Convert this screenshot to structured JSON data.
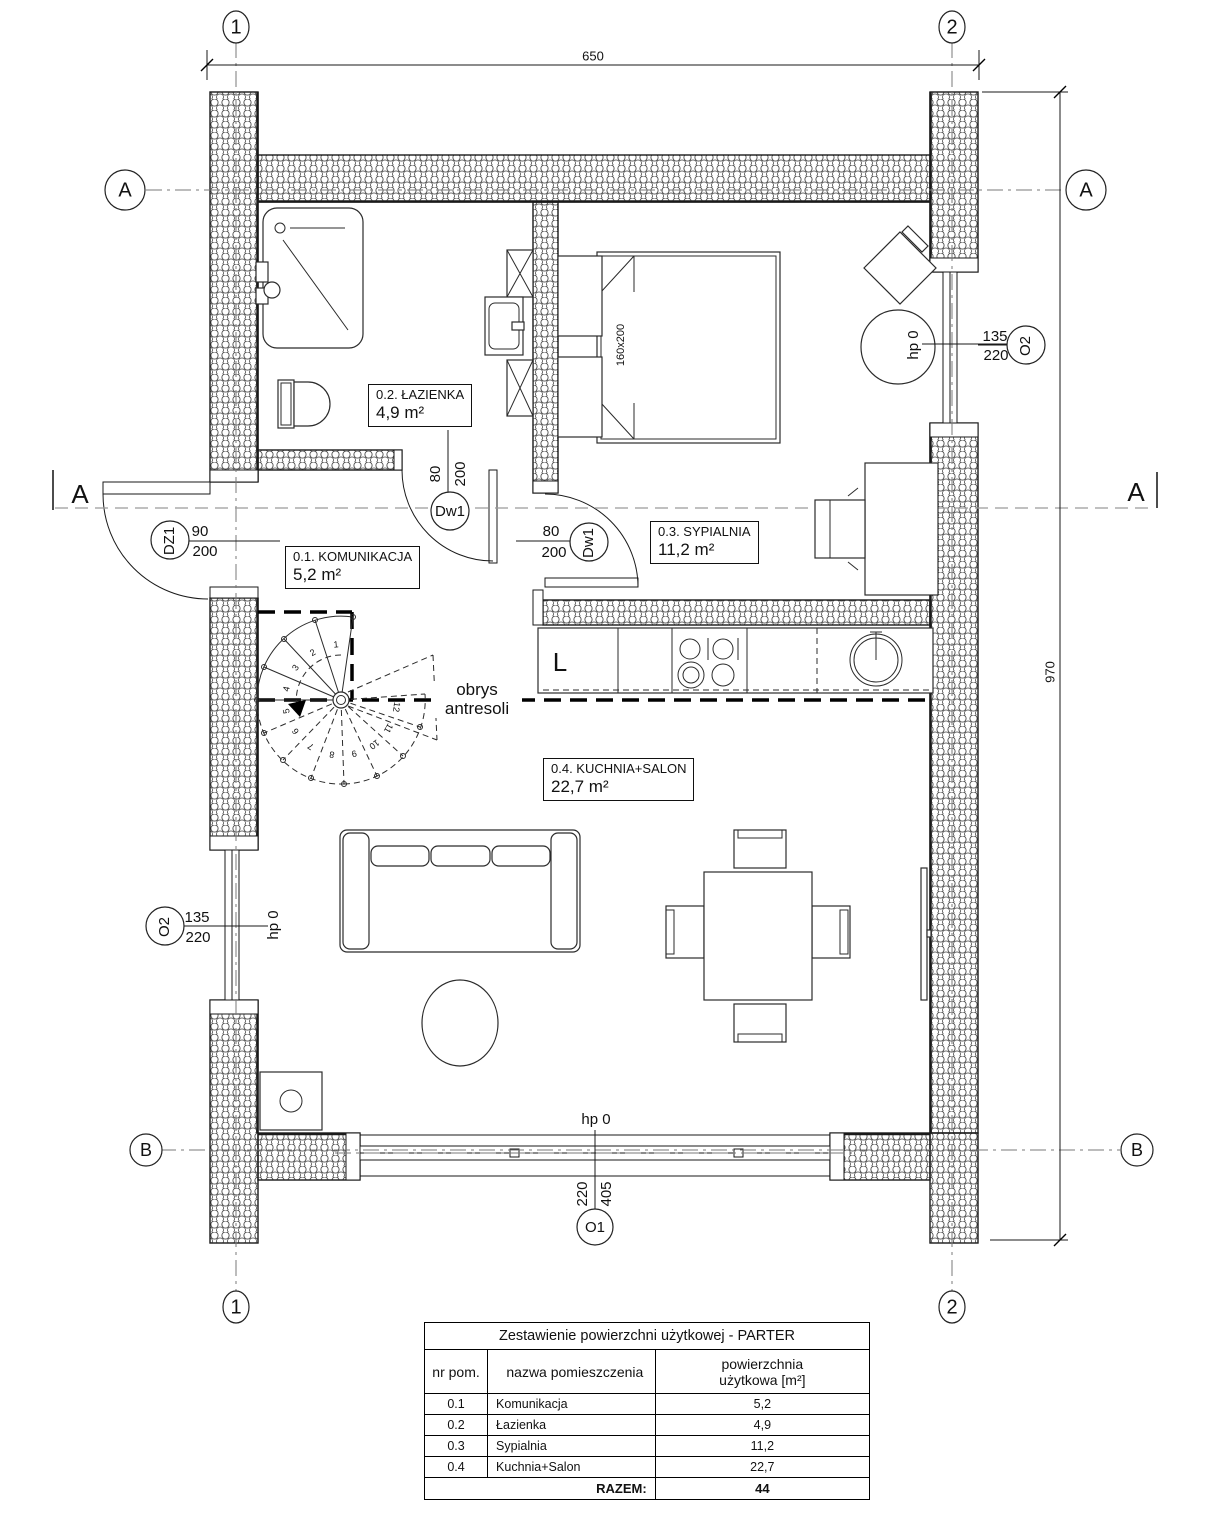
{
  "axes": {
    "one": "1",
    "two": "2",
    "a": "A",
    "b": "B"
  },
  "section": {
    "letter": "A"
  },
  "dims": {
    "top": "650",
    "right": "970"
  },
  "tags": {
    "dz1": {
      "name": "DZ1",
      "num": "90",
      "den": "200"
    },
    "dw1_bath": {
      "name": "Dw1",
      "num": "80",
      "den": "200"
    },
    "dw1_bed": {
      "name": "Dw1",
      "num": "80",
      "den": "200"
    },
    "o2_right": {
      "name": "O2",
      "num": "135",
      "den": "220"
    },
    "o2_left": {
      "name": "O2",
      "num": "135",
      "den": "220"
    },
    "o1": {
      "name": "O1",
      "num": "405",
      "den": "220"
    }
  },
  "levels": {
    "right": "hp 0",
    "left": "hp 0",
    "bottom": "hp 0"
  },
  "mezzanine": {
    "line1": "obrys",
    "line2": "antresoli"
  },
  "kitchen": {
    "fridge": "L"
  },
  "bed": {
    "size": "160x200"
  },
  "rooms": {
    "komunikacja": {
      "title": "0.1. KOMUNIKACJA",
      "area": "5,2 m²"
    },
    "lazienka": {
      "title": "0.2. ŁAZIENKA",
      "area": "4,9 m²"
    },
    "sypialnia": {
      "title": "0.3. SYPIALNIA",
      "area": "11,2 m²"
    },
    "kuchnia": {
      "title": "0.4. KUCHNIA+SALON",
      "area": "22,7 m²"
    }
  },
  "stairs": {
    "steps": [
      "1",
      "2",
      "3",
      "4",
      "5",
      "6",
      "7",
      "8",
      "9",
      "10",
      "11",
      "12"
    ]
  },
  "table": {
    "title": "Zestawienie powierzchni użytkowej - PARTER",
    "headers": {
      "col1": "nr pom.",
      "col2": "nazwa pomieszczenia",
      "col3_line1": "powierzchnia",
      "col3_line2": "użytkowa [m²]"
    },
    "rows": [
      {
        "nr": "0.1",
        "name": "Komunikacja",
        "area": "5,2"
      },
      {
        "nr": "0.2",
        "name": "Łazienka",
        "area": "4,9"
      },
      {
        "nr": "0.3",
        "name": "Sypialnia",
        "area": "11,2"
      },
      {
        "nr": "0.4",
        "name": "Kuchnia+Salon",
        "area": "22,7"
      }
    ],
    "total_label": "RAZEM:",
    "total_value": "44"
  }
}
